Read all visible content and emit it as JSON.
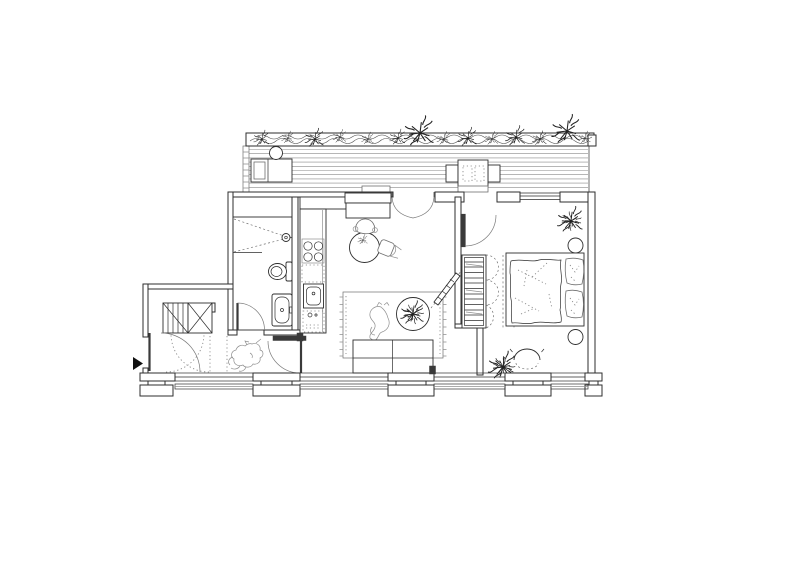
{
  "meta": {
    "title": "Apartment floor plan",
    "description": "Black-and-white architectural plan drawing of a small apartment with terrace, bathroom, kitchen, living room, entry hall and bedroom"
  },
  "colors": {
    "background": "#ffffff",
    "ink": "#2e2e2e",
    "ink_dark": "#3a3a3a",
    "ink_light": "#8f8f8f",
    "arrow_black": "#111111"
  },
  "elements": {
    "entrance_marker": "entrance-arrow-icon",
    "terrace": [
      "planter-with-plants",
      "deck-boards",
      "lounge-chair",
      "terrace-side-table",
      "outdoor-dining-table",
      "outdoor-chairs"
    ],
    "entry": [
      "wardrobe-closet",
      "closet-door-swings",
      "entrance-door",
      "dog"
    ],
    "bathroom": [
      "shower",
      "shower-head",
      "toilet",
      "washbasin",
      "bathroom-door"
    ],
    "kitchen": [
      "kitchen-counter",
      "tall-cabinet",
      "hob-4-burners",
      "dishwasher",
      "kitchen-sink",
      "washing-machine",
      "round-dining-table",
      "dining-chairs",
      "table-plant"
    ],
    "living_room": [
      "rug-with-fringe",
      "cat",
      "round-coffee-table",
      "coffee-table-plant",
      "sofa",
      "french-door-to-terrace",
      "hall-door",
      "pivot-panel"
    ],
    "bedroom": [
      "terrace-door",
      "window",
      "wardrobe-shelves",
      "wardrobe-door-swings",
      "double-bed",
      "pillows",
      "round-pouf",
      "round-side-table",
      "bedroom-chair",
      "plants"
    ],
    "facade": [
      "window-bays",
      "pilasters",
      "window-sills"
    ]
  }
}
